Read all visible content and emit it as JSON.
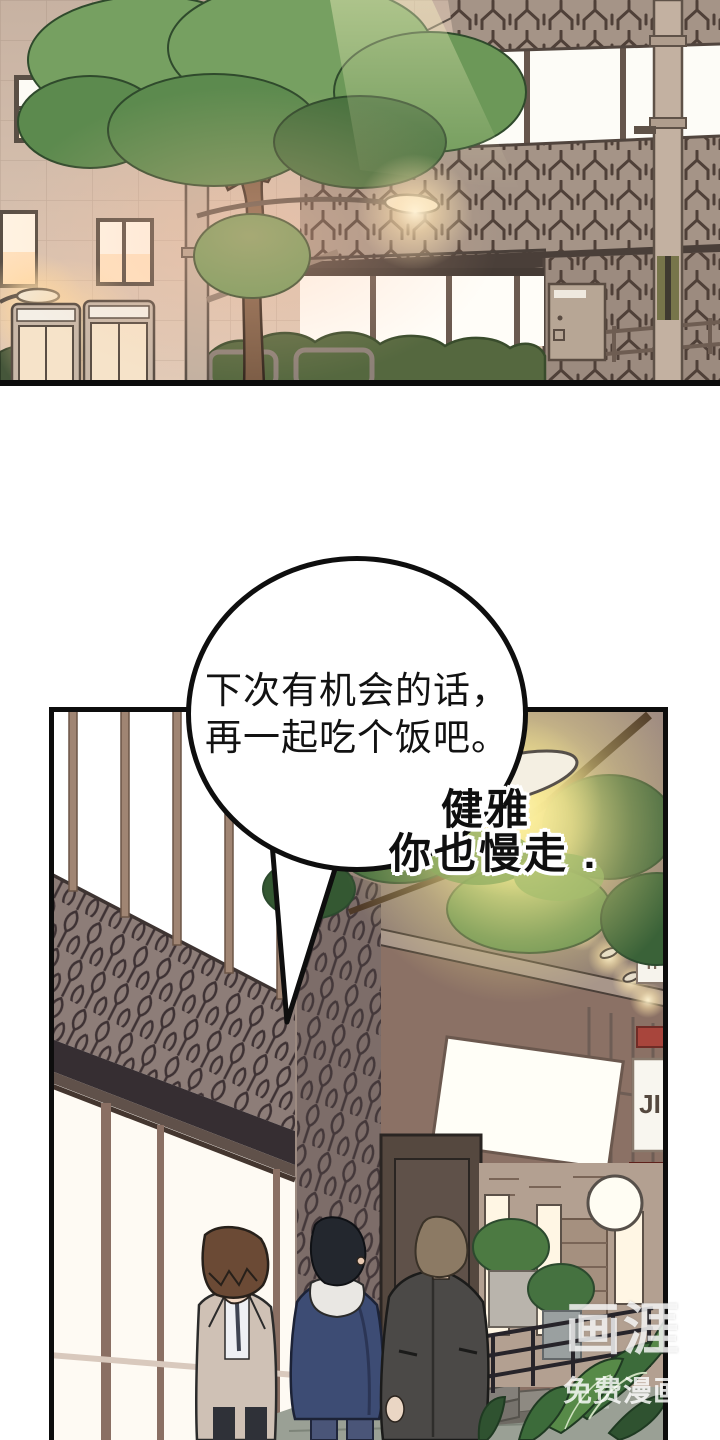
{
  "speech_bubble": {
    "line1": "下次有机会的话，",
    "line2": "再一起吃个饭吧。",
    "fill": "#ffffff",
    "border_color": "#0e0e0e",
    "text_color": "#121212"
  },
  "caption": {
    "line1": "健雅",
    "line2": "你也慢走 .",
    "text_color": "#0f0f0f",
    "outline_color": "#ffffff"
  },
  "watermark": {
    "logo": "画涯",
    "subtitle": "免费漫画",
    "color": "rgba(255,255,255,0.8)"
  },
  "signs": {
    "storefront_vertical": "JI",
    "small_banner": "ri"
  },
  "palette": {
    "panel1_wall": "#d3bfae",
    "panel1_pattern_band": "#a59487",
    "panel2_pattern_wall": "#8d7d78",
    "tree_green": "#76a061",
    "night_foliage": "#4e7a42",
    "lamp_glow": "#fdf2b2",
    "warm_window": "#ffe7c9",
    "storefront_white": "#fefaf3",
    "navy_jacket": "#3d4c74",
    "beige_blazer": "#cfc1b5",
    "charcoal_coat": "#4b4947",
    "panel_border": "#0d0d0d",
    "ground": "#9aa095"
  }
}
